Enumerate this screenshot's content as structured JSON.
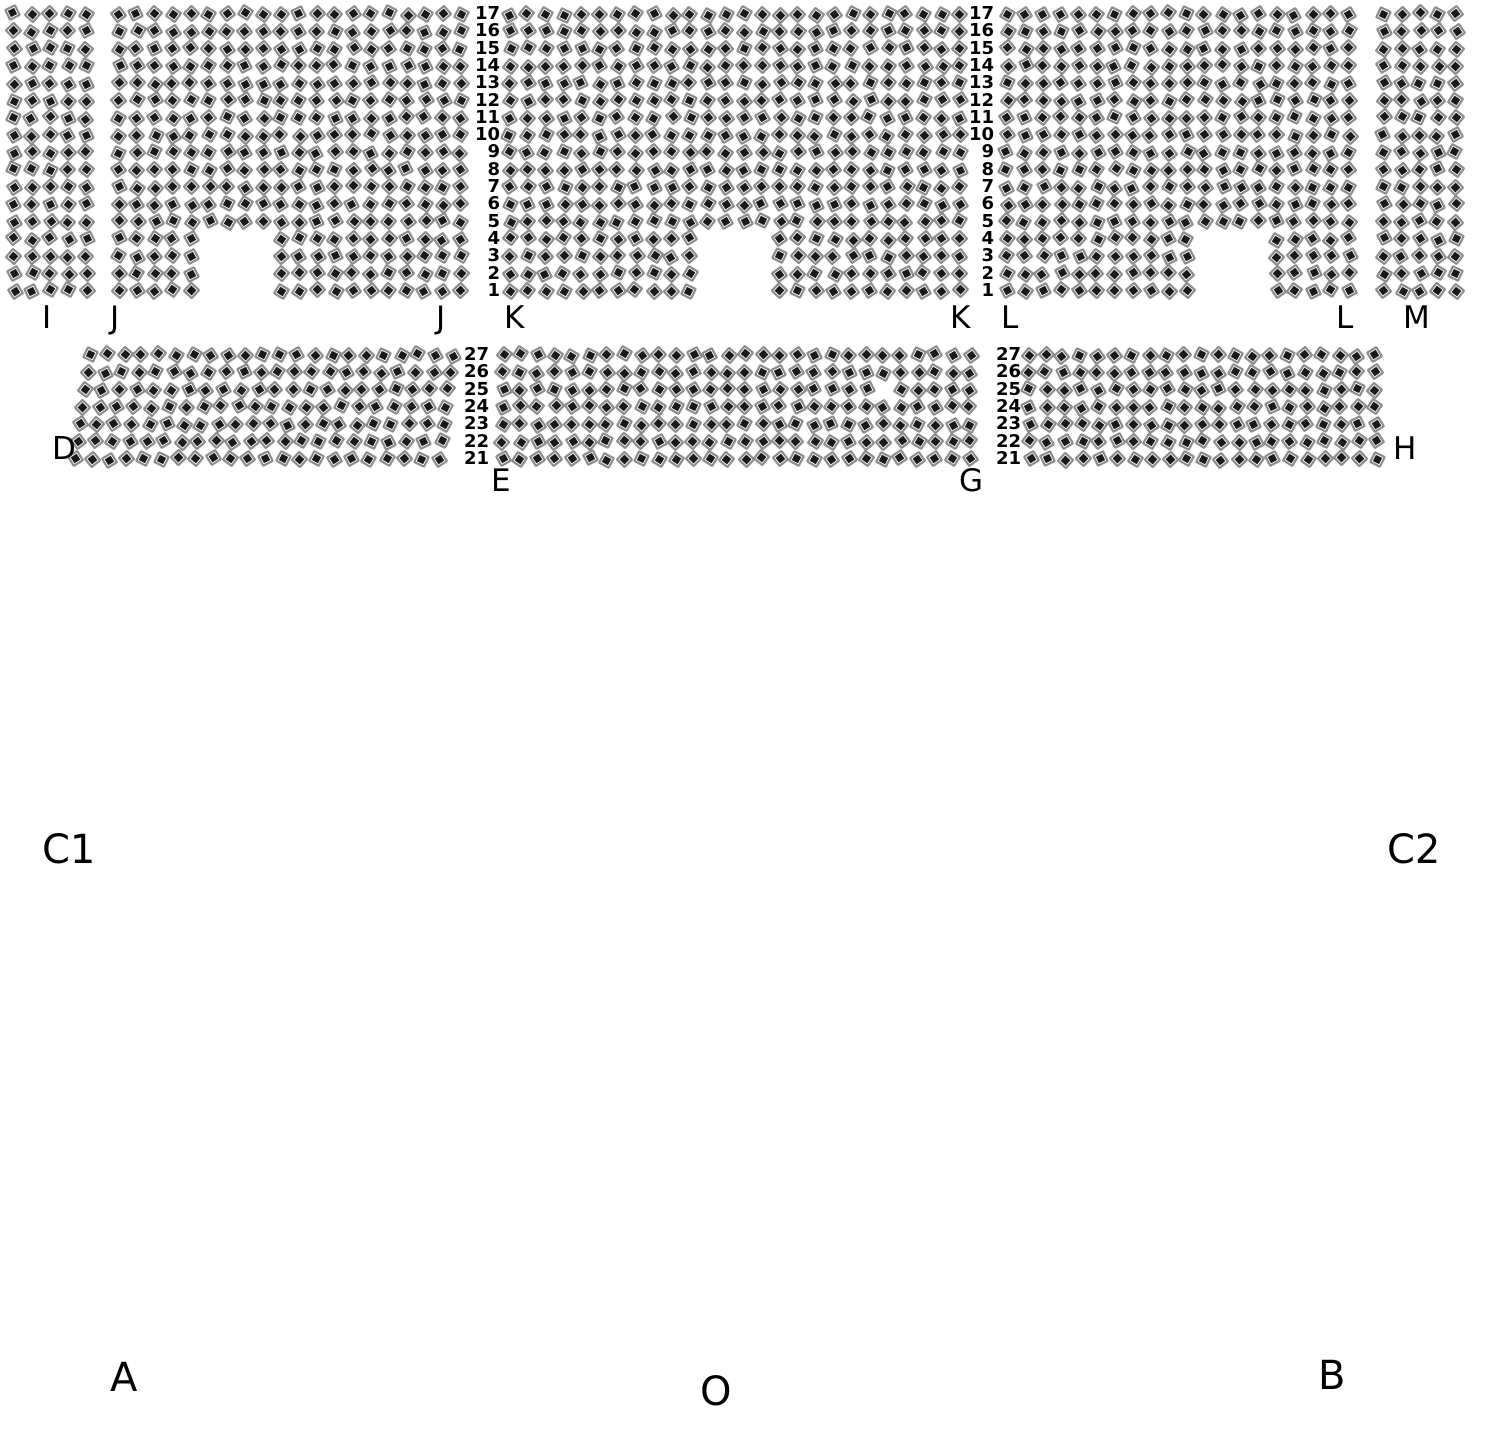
{
  "page": {
    "background": "#ffffff",
    "label_color": "#000000"
  },
  "seats": {
    "icon": "chair-top-view-icon",
    "size": 13,
    "frame_color": "#8d8d8d",
    "cushion_color": "#191919",
    "gap_color": "#ffffff"
  },
  "seat_map": {
    "sections": [
      {
        "name": "I",
        "x": 14,
        "y": 14,
        "cols": 5,
        "rows": 17,
        "pitch_x": 18,
        "pitch_y": 17.3,
        "shear": 0,
        "gaps": []
      },
      {
        "name": "J",
        "x": 119,
        "y": 14,
        "cols": 20,
        "rows": 17,
        "pitch_x": 18,
        "pitch_y": 17.3,
        "shear": 0,
        "gaps": [
          {
            "r0": 13,
            "r1": 16,
            "c0": 5,
            "c1": 8
          }
        ]
      },
      {
        "name": "K",
        "x": 510,
        "y": 14,
        "cols": 26,
        "rows": 17,
        "pitch_x": 18,
        "pitch_y": 17.3,
        "shear": 0,
        "gaps": [
          {
            "r0": 13,
            "r1": 16,
            "c0": 11,
            "c1": 14
          }
        ]
      },
      {
        "name": "L",
        "x": 1007,
        "y": 14,
        "cols": 20,
        "rows": 17,
        "pitch_x": 18,
        "pitch_y": 17.3,
        "shear": 0,
        "gaps": [
          {
            "r0": 13,
            "r1": 16,
            "c0": 11,
            "c1": 14
          }
        ]
      },
      {
        "name": "M",
        "x": 1384,
        "y": 14,
        "cols": 5,
        "rows": 17,
        "pitch_x": 18,
        "pitch_y": 17.3,
        "shear": 0,
        "gaps": []
      },
      {
        "name": "D",
        "x": 90,
        "y": 355,
        "cols": 22,
        "rows": 7,
        "pitch_x": 17.3,
        "pitch_y": 17.3,
        "shear": -2.5,
        "gaps": []
      },
      {
        "name": "EG",
        "x": 503,
        "y": 355,
        "cols": 28,
        "rows": 7,
        "pitch_x": 17.3,
        "pitch_y": 17.3,
        "shear": 0,
        "gaps": [
          {
            "r0": 2,
            "r1": 2,
            "c0": 22,
            "c1": 22
          }
        ]
      },
      {
        "name": "GH",
        "x": 1028,
        "y": 355,
        "cols": 21,
        "rows": 7,
        "pitch_x": 17.3,
        "pitch_y": 17.3,
        "shear": 0.5,
        "gaps": []
      }
    ],
    "row_number_columns": [
      {
        "id": "top-left",
        "x_right": 500,
        "y": 14,
        "pitch": 17.3,
        "values": [
          "17",
          "16",
          "15",
          "14",
          "13",
          "12",
          "11",
          "10",
          "9",
          "8",
          "7",
          "6",
          "5",
          "4",
          "3",
          "2",
          "1"
        ]
      },
      {
        "id": "top-right",
        "x_right": 994,
        "y": 14,
        "pitch": 17.3,
        "values": [
          "17",
          "16",
          "15",
          "14",
          "13",
          "12",
          "11",
          "10",
          "9",
          "8",
          "7",
          "6",
          "5",
          "4",
          "3",
          "2",
          "1"
        ]
      },
      {
        "id": "mid-left",
        "x_right": 489,
        "y": 355,
        "pitch": 17.3,
        "values": [
          "27",
          "26",
          "25",
          "24",
          "23",
          "22",
          "21"
        ]
      },
      {
        "id": "mid-right",
        "x_right": 1021,
        "y": 355,
        "pitch": 17.3,
        "values": [
          "27",
          "26",
          "25",
          "24",
          "23",
          "22",
          "21"
        ]
      }
    ],
    "section_labels": [
      {
        "text": "I",
        "x": 42,
        "y": 303
      },
      {
        "text": "J",
        "x": 110,
        "y": 303
      },
      {
        "text": "J",
        "x": 436,
        "y": 303
      },
      {
        "text": "K",
        "x": 504,
        "y": 303
      },
      {
        "text": "K",
        "x": 950,
        "y": 303
      },
      {
        "text": "L",
        "x": 1001,
        "y": 303
      },
      {
        "text": "L",
        "x": 1336,
        "y": 303
      },
      {
        "text": "M",
        "x": 1403,
        "y": 303
      },
      {
        "text": "D",
        "x": 52,
        "y": 434
      },
      {
        "text": "E",
        "x": 491,
        "y": 466
      },
      {
        "text": "G",
        "x": 959,
        "y": 466
      },
      {
        "text": "H",
        "x": 1393,
        "y": 434
      }
    ],
    "area_labels": [
      {
        "text": "C1",
        "x": 42,
        "y": 830
      },
      {
        "text": "C2",
        "x": 1387,
        "y": 830
      },
      {
        "text": "A",
        "x": 110,
        "y": 1358
      },
      {
        "text": "O",
        "x": 700,
        "y": 1372
      },
      {
        "text": "B",
        "x": 1318,
        "y": 1356
      }
    ]
  }
}
